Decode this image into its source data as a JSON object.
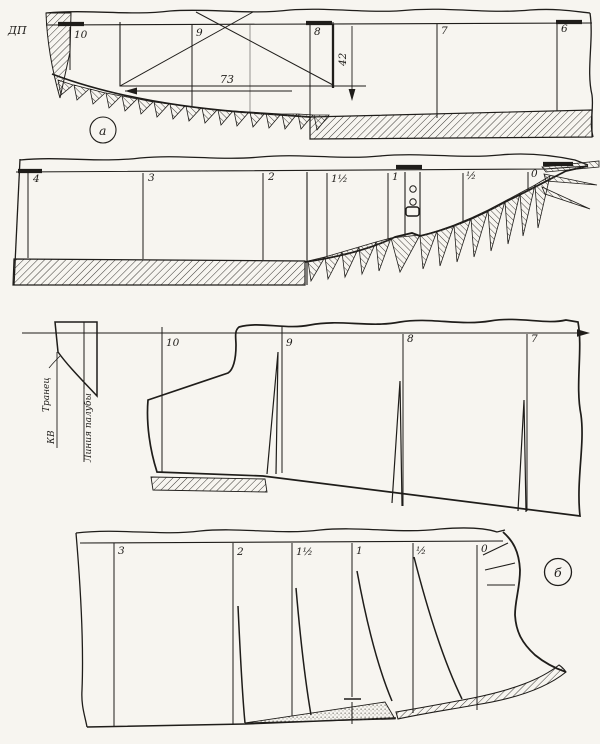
{
  "labels": {
    "dp": "ДП",
    "panel_a": "а",
    "panel_b": "б",
    "dim_width": "73",
    "dim_height": "42",
    "transom": "Транец",
    "waterline": "КВ",
    "deck_line": "Линия палубы"
  },
  "stations": {
    "strip1": [
      "10",
      "9",
      "8",
      "7",
      "6"
    ],
    "strip2": [
      "4",
      "3",
      "2",
      "1½",
      "1",
      "½",
      "0"
    ],
    "strip3": [
      "10",
      "9",
      "8",
      "7"
    ],
    "strip4": [
      "3",
      "2",
      "1½",
      "1",
      "½",
      "0"
    ]
  },
  "colors": {
    "paper": "#f7f5f0",
    "ink": "#1f1d1a"
  }
}
